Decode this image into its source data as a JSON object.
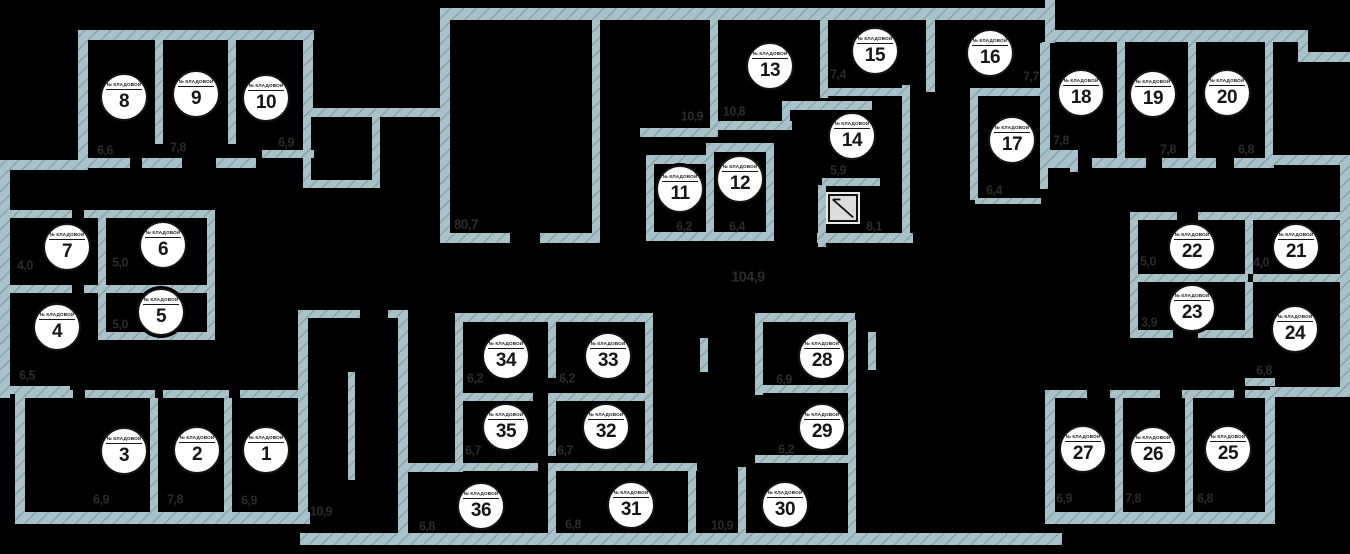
{
  "plan": {
    "background": "#000000",
    "wall_color": "#a9c1c9",
    "wall_hatch_color": "#829ca4",
    "marker": {
      "label": "№ КЛАДОВОЙ",
      "fill": "#ffffff",
      "text_color": "#161616"
    },
    "area_text_color": "#2c2c2c",
    "rooms": [
      {
        "n": "1",
        "x": 266,
        "y": 450
      },
      {
        "n": "2",
        "x": 197,
        "y": 450
      },
      {
        "n": "3",
        "x": 124,
        "y": 451
      },
      {
        "n": "4",
        "x": 57,
        "y": 327
      },
      {
        "n": "5",
        "x": 161,
        "y": 312
      },
      {
        "n": "6",
        "x": 163,
        "y": 245
      },
      {
        "n": "7",
        "x": 67,
        "y": 247
      },
      {
        "n": "8",
        "x": 124,
        "y": 97
      },
      {
        "n": "9",
        "x": 196,
        "y": 94
      },
      {
        "n": "10",
        "x": 266,
        "y": 98
      },
      {
        "n": "11",
        "x": 680,
        "y": 189
      },
      {
        "n": "12",
        "x": 740,
        "y": 179
      },
      {
        "n": "13",
        "x": 770,
        "y": 66
      },
      {
        "n": "14",
        "x": 852,
        "y": 136
      },
      {
        "n": "15",
        "x": 875,
        "y": 51
      },
      {
        "n": "16",
        "x": 990,
        "y": 53
      },
      {
        "n": "17",
        "x": 1012,
        "y": 140
      },
      {
        "n": "18",
        "x": 1081,
        "y": 93
      },
      {
        "n": "19",
        "x": 1153,
        "y": 94
      },
      {
        "n": "20",
        "x": 1227,
        "y": 93
      },
      {
        "n": "21",
        "x": 1296,
        "y": 247
      },
      {
        "n": "22",
        "x": 1192,
        "y": 247
      },
      {
        "n": "23",
        "x": 1192,
        "y": 308
      },
      {
        "n": "24",
        "x": 1295,
        "y": 329
      },
      {
        "n": "25",
        "x": 1228,
        "y": 449
      },
      {
        "n": "26",
        "x": 1153,
        "y": 450
      },
      {
        "n": "27",
        "x": 1083,
        "y": 449
      },
      {
        "n": "28",
        "x": 822,
        "y": 356
      },
      {
        "n": "29",
        "x": 822,
        "y": 427
      },
      {
        "n": "30",
        "x": 785,
        "y": 505
      },
      {
        "n": "31",
        "x": 631,
        "y": 505
      },
      {
        "n": "32",
        "x": 606,
        "y": 427
      },
      {
        "n": "33",
        "x": 608,
        "y": 356
      },
      {
        "n": "34",
        "x": 506,
        "y": 356
      },
      {
        "n": "35",
        "x": 506,
        "y": 427
      },
      {
        "n": "36",
        "x": 481,
        "y": 506
      }
    ],
    "area_labels": [
      {
        "text": "6,6",
        "x": 105,
        "y": 150,
        "for": "room-8"
      },
      {
        "text": "7,8",
        "x": 178,
        "y": 147,
        "for": "room-9"
      },
      {
        "text": "6,9",
        "x": 286,
        "y": 142,
        "for": "room-10"
      },
      {
        "text": "4,0",
        "x": 25,
        "y": 265,
        "for": "room-7"
      },
      {
        "text": "5,0",
        "x": 120,
        "y": 262,
        "for": "room-6"
      },
      {
        "text": "5,0",
        "x": 120,
        "y": 324,
        "for": "room-5"
      },
      {
        "text": "6,5",
        "x": 27,
        "y": 375,
        "for": "room-4"
      },
      {
        "text": "6,9",
        "x": 101,
        "y": 499,
        "for": "room-3"
      },
      {
        "text": "7,8",
        "x": 175,
        "y": 499,
        "for": "room-2"
      },
      {
        "text": "6,9",
        "x": 249,
        "y": 500,
        "for": "room-1"
      },
      {
        "text": "10,9",
        "x": 321,
        "y": 511,
        "for": "stairwell"
      },
      {
        "text": "80,7",
        "x": 466,
        "y": 224,
        "s": 14,
        "for": "hall-left"
      },
      {
        "text": "104,9",
        "x": 748,
        "y": 277,
        "s": 15,
        "for": "corridor-main"
      },
      {
        "text": "10,9",
        "x": 692,
        "y": 116,
        "for": "corridor-upper"
      },
      {
        "text": "10,8",
        "x": 734,
        "y": 111,
        "for": "room-13"
      },
      {
        "text": "6,2",
        "x": 684,
        "y": 226,
        "for": "room-11"
      },
      {
        "text": "6,4",
        "x": 737,
        "y": 226,
        "for": "room-12"
      },
      {
        "text": "7,4",
        "x": 838,
        "y": 74,
        "for": "room-15"
      },
      {
        "text": "5,9",
        "x": 838,
        "y": 170,
        "for": "room-14"
      },
      {
        "text": "8,1",
        "x": 874,
        "y": 226,
        "for": "elevator-area"
      },
      {
        "text": "7,7",
        "x": 1031,
        "y": 76,
        "for": "room-16"
      },
      {
        "text": "6,4",
        "x": 994,
        "y": 190,
        "for": "room-17"
      },
      {
        "text": "7,8",
        "x": 1061,
        "y": 140,
        "for": "room-18"
      },
      {
        "text": "7,8",
        "x": 1168,
        "y": 149,
        "for": "room-19"
      },
      {
        "text": "6,8",
        "x": 1246,
        "y": 149,
        "for": "room-20"
      },
      {
        "text": "5,0",
        "x": 1148,
        "y": 261,
        "for": "room-22"
      },
      {
        "text": "4,0",
        "x": 1261,
        "y": 262,
        "for": "room-21"
      },
      {
        "text": "3,9",
        "x": 1149,
        "y": 322,
        "for": "room-23"
      },
      {
        "text": "6,8",
        "x": 1264,
        "y": 370,
        "for": "room-24"
      },
      {
        "text": "6,2",
        "x": 475,
        "y": 378,
        "for": "room-34"
      },
      {
        "text": "6,2",
        "x": 567,
        "y": 378,
        "for": "room-33"
      },
      {
        "text": "6,7",
        "x": 473,
        "y": 450,
        "for": "room-35"
      },
      {
        "text": "6,7",
        "x": 565,
        "y": 450,
        "for": "room-32"
      },
      {
        "text": "6,8",
        "x": 427,
        "y": 526,
        "for": "room-36"
      },
      {
        "text": "6,8",
        "x": 573,
        "y": 524,
        "for": "room-31"
      },
      {
        "text": "10,9",
        "x": 722,
        "y": 525,
        "for": "corridor-lower"
      },
      {
        "text": "6,9",
        "x": 784,
        "y": 379,
        "for": "room-28"
      },
      {
        "text": "6,2",
        "x": 786,
        "y": 449,
        "for": "room-29"
      },
      {
        "text": "6,9",
        "x": 1064,
        "y": 498,
        "for": "room-27"
      },
      {
        "text": "7,8",
        "x": 1133,
        "y": 498,
        "for": "room-26"
      },
      {
        "text": "6,8",
        "x": 1205,
        "y": 498,
        "for": "room-25"
      }
    ],
    "elevator": {
      "x": 828,
      "y": 194,
      "w": 30,
      "h": 28
    }
  }
}
